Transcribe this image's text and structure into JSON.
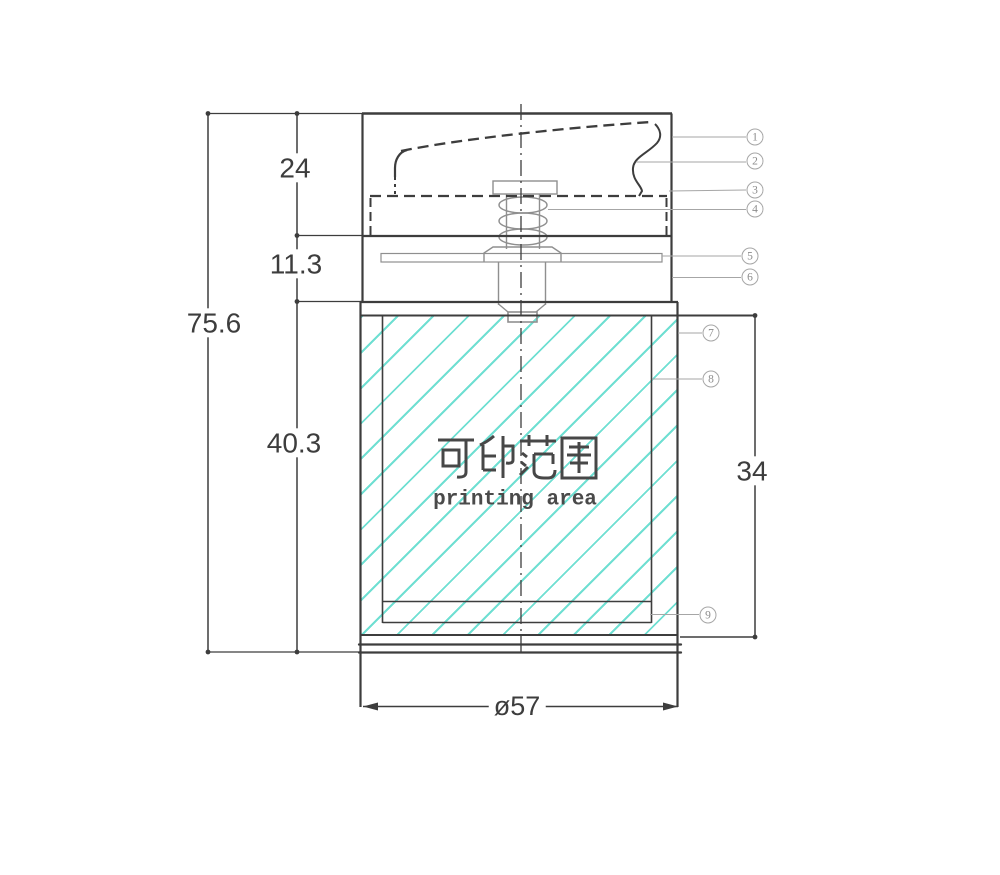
{
  "drawing": {
    "dimensions": {
      "total_height": "75.6",
      "cap_height": "24",
      "neck_height": "11.3",
      "body_height": "40.3",
      "printing_height": "34",
      "diameter": "ø57"
    },
    "printing_area": {
      "label_cn": "可印范围",
      "label_en": "printing area"
    },
    "callouts": [
      "1",
      "2",
      "3",
      "4",
      "5",
      "6",
      "7",
      "8",
      "9"
    ]
  },
  "colors": {
    "line": "#3d3d3d",
    "leader": "#a6a6a6",
    "part": "#8f8f8f",
    "hatch": "#6fdfd2",
    "text": "#3d3d3d"
  }
}
